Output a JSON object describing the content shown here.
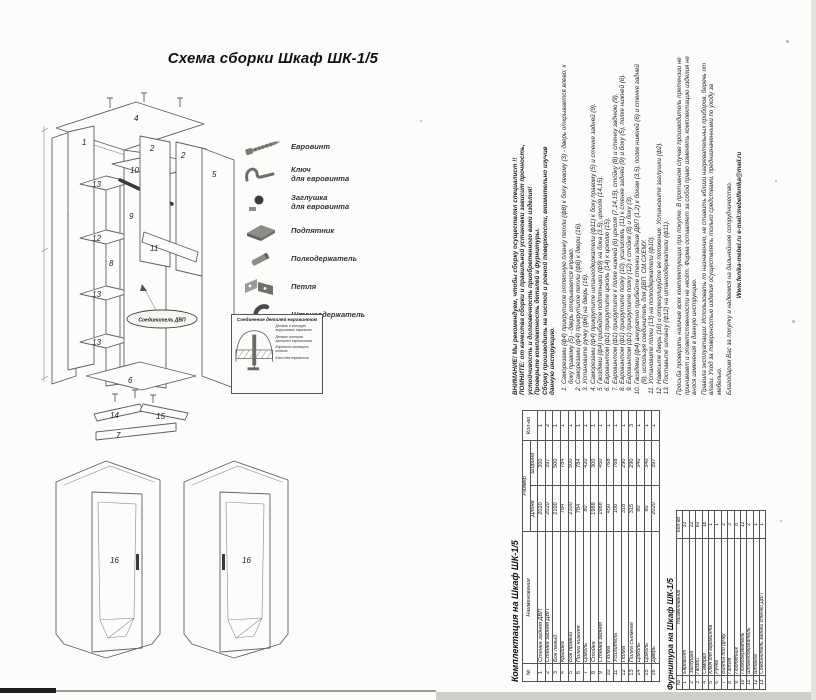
{
  "page": {
    "title": "Схема сборки Шкаф ШК-1/5"
  },
  "legend": {
    "items": [
      {
        "icon": "euroscrew-icon",
        "label": "Евровинт"
      },
      {
        "icon": "hexkey-icon",
        "label": "Ключ\nдля евровинта"
      },
      {
        "icon": "plug-icon",
        "label": "Заглушка\nдля евровинта"
      },
      {
        "icon": "footpad-icon",
        "label": "Подпятник"
      },
      {
        "icon": "shelfpin-icon",
        "label": "Полкодержатель"
      },
      {
        "icon": "hinge-icon",
        "label": "Петля"
      },
      {
        "icon": "rodholder-icon",
        "label": "Штангодержатель"
      }
    ]
  },
  "connection_box": {
    "title": "Соединение деталей евровинтом",
    "labels": [
      "Деталь в которую\nвкручивают евровинт",
      "Деталь которая\nкрепится евровинтом",
      "Евровинт затянуть ключом",
      "Ключ для евровинта"
    ]
  },
  "diagram": {
    "parts": {
      "p1": "1",
      "p2a": "2",
      "p2b": "2",
      "p3": "3",
      "p4": "4",
      "p5": "5",
      "p6": "6",
      "p7": "7",
      "p8": "8",
      "p9": "9",
      "p10": "10",
      "p11": "11",
      "p12": "12",
      "p13a": "13",
      "p13b": "13",
      "p13c": "13",
      "p14": "14",
      "p15": "15",
      "p16a": "16",
      "p16b": "16"
    },
    "connector_label": "Соединитель ДВП"
  },
  "instructions": {
    "intro": [
      "ВНИМАНИЕ! Мы рекомендуем, чтобы сборку осуществлял специалист !!",
      "ПОМНИТЕ: от качества сборки и правильной установки зависит прочность,",
      "устойчивость и долговечность приобретенного вами изделия!",
      "Проверьте комплектность деталей и фурнитуры.",
      "Сборку производить на чистой и ровной поверхности, внимательно изучив",
      "данную инструкцию."
    ],
    "steps": [
      "Саморезами (ф4) прикрутите отпятную планку петли (ф8) к боку левому (3) - дверь открывается влево; к боку правому (5) - дверь открывается вправо.",
      "Саморезами (ф4) прикрутите петли (ф8) к двери (16).",
      "Установите ручку (ф6) на дверь (16).",
      "Саморезами (ф4) прикрутите штангодержатели (ф11) к боку правому (5) и стенке задней (9).",
      "Гвоздями (ф4) прибейте подпятники (ф9) на бока (3,5), цоколя (14,15).",
      "Евровинтом (ф1) прикрутите цоколь (14) к цоколю (15).",
      "Евровинтом (ф1) прикрутите к полке нижней (6) цоколя (7,14,15), стойку (8) и стенку заднюю (9).",
      "Евровинтом (ф1) прикрутите полку (10), усилитель (11) к стенке задней (9) и боку (5), полке нижней (6).",
      "Евровинтом (ф1) прикрутите полку (12) к стойке (8) и боку (3).",
      "Гвоздями (ф4) аккуратно прибейте стенки задние ДВП (1,2) к бокам (3,5), полке нижней (6) и стенке задней (9), используя соединитель для ДВП. СМ.СХЕМУ.",
      "Установите полки (13) на полкодержатели (ф10).",
      "Навесьте дверь (16) и отрегулируйте ее положение. Установите заглушки (ф2).",
      "Поставьте штангу (ф12) на штангодержатели (ф11)."
    ],
    "footer": [
      "Просьба проверить наличие всех комплектующих при покупке. В противном случае производитель претензии не принимает и ответственности не несёт. Фирма оставляет за собой право изменять комплектацию изделия не внося изменения в данную инструкцию.",
      "Правила эксплуатации: Использовать по назначению, не ставить вблизи нагревательных приборов, беречь от влаги. Уход за поверхностью изделия осуществлять только средствами, предназначенными по уходу за мебелью.",
      "Благодарим Вас за покупку и надеемся на дальнейшее сотрудничество."
    ],
    "contacts": "Www.fenika-mebel.ru    e-mail:mebelfenika@mail.ru"
  },
  "tables": {
    "components": {
      "title": "Комплектация на Шкаф ШК-1/5",
      "col_num": "№",
      "col_name": "Наименование",
      "col_size": "Размер",
      "col_len": "Длина",
      "col_wid": "Ширина",
      "col_qty": "Кол-во",
      "rows": [
        [
          "1",
          "Стенка задняя ДВП",
          "2020",
          "350",
          "1"
        ],
        [
          "2",
          "Стенка задняя ДВП",
          "2020",
          "397",
          "2"
        ],
        [
          "3",
          "Бок левый",
          "2100",
          "500",
          "1"
        ],
        [
          "4",
          "Крышка",
          "784",
          "784",
          "1"
        ],
        [
          "5",
          "Бок правый",
          "2100",
          "500",
          "1"
        ],
        [
          "6",
          "Полка нижняя",
          "784",
          "784",
          "1"
        ],
        [
          "7",
          "Цоколь",
          "80",
          "420",
          "1"
        ],
        [
          "8",
          "Стойка",
          "1988",
          "300",
          "1"
        ],
        [
          "9",
          "Стенка задняя",
          "1988",
          "450",
          "1"
        ],
        [
          "10",
          "Полка",
          "450",
          "768",
          "1"
        ],
        [
          "11",
          "Усилитель",
          "100",
          "768",
          "1"
        ],
        [
          "12",
          "Полка",
          "318",
          "290",
          "1"
        ],
        [
          "13",
          "Полка съемная",
          "315",
          "290",
          "3"
        ],
        [
          "14",
          "Цоколь",
          "80",
          "340",
          "1"
        ],
        [
          "15",
          "Цоколь",
          "80",
          "340",
          "1"
        ],
        [
          "16",
          "Дверь",
          "2020",
          "397",
          "1"
        ]
      ]
    },
    "hardware": {
      "title": "Фурнитура на Шкаф ШК-1/5",
      "col_num": "№",
      "col_name": "Наименование",
      "col_qty": "Кол-во",
      "rows": [
        [
          "1",
          "Евровинт",
          "33"
        ],
        [
          "2",
          "Заглушка",
          "22"
        ],
        [
          "3",
          "Гвозди",
          "60"
        ],
        [
          "4",
          "Саморез",
          "18"
        ],
        [
          "5",
          "Ключ для евровинта",
          "1"
        ],
        [
          "6",
          "Ручка",
          "1"
        ],
        [
          "7",
          "Винты под ручку",
          "2"
        ],
        [
          "8",
          "Петля",
          "3"
        ],
        [
          "9",
          "Подпятник",
          "8"
        ],
        [
          "10",
          "Полкодержатель",
          "12"
        ],
        [
          "11",
          "Штангодержатель",
          "2"
        ],
        [
          "12",
          "Штанга",
          "1"
        ],
        [
          "13",
          "Соединитель задней стенки ДВП",
          "1"
        ]
      ]
    }
  }
}
